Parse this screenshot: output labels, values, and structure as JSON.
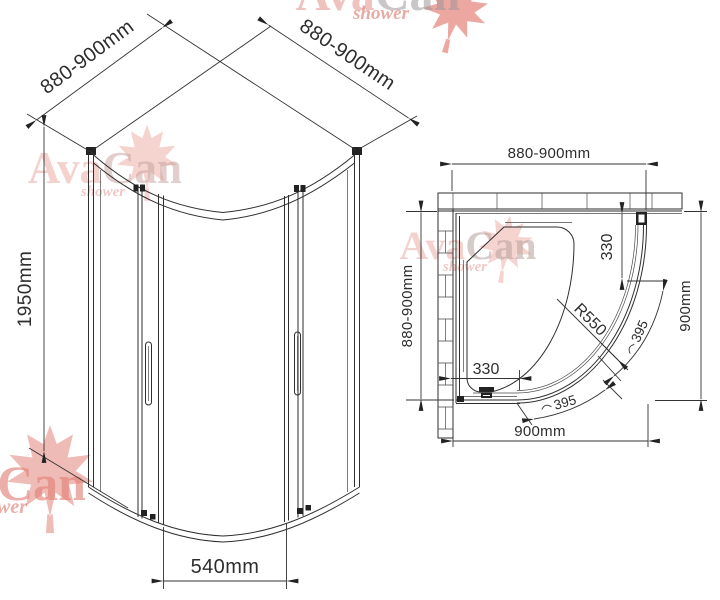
{
  "brand": {
    "ava": "Ava",
    "can": "Can",
    "shower": "shower"
  },
  "iso": {
    "dim_wall_left": "880-900mm",
    "dim_wall_right": "880-900mm",
    "dim_height": "1950mm",
    "dim_opening": "540mm"
  },
  "plan": {
    "dim_top": "880-900mm",
    "dim_left": "880-900mm",
    "dim_right": "900mm",
    "dim_bottom": "900mm",
    "dim_offset_h": "330",
    "dim_offset_v": "330",
    "dim_radius": "R550",
    "dim_arc_upper": "395",
    "dim_arc_lower": "395"
  },
  "colors": {
    "line": "#2e2e2e",
    "dim_text": "#333333",
    "watermark_pink": "#e59a93",
    "watermark_gray": "#a39a9a",
    "leaf_red": "#dd5f52"
  }
}
